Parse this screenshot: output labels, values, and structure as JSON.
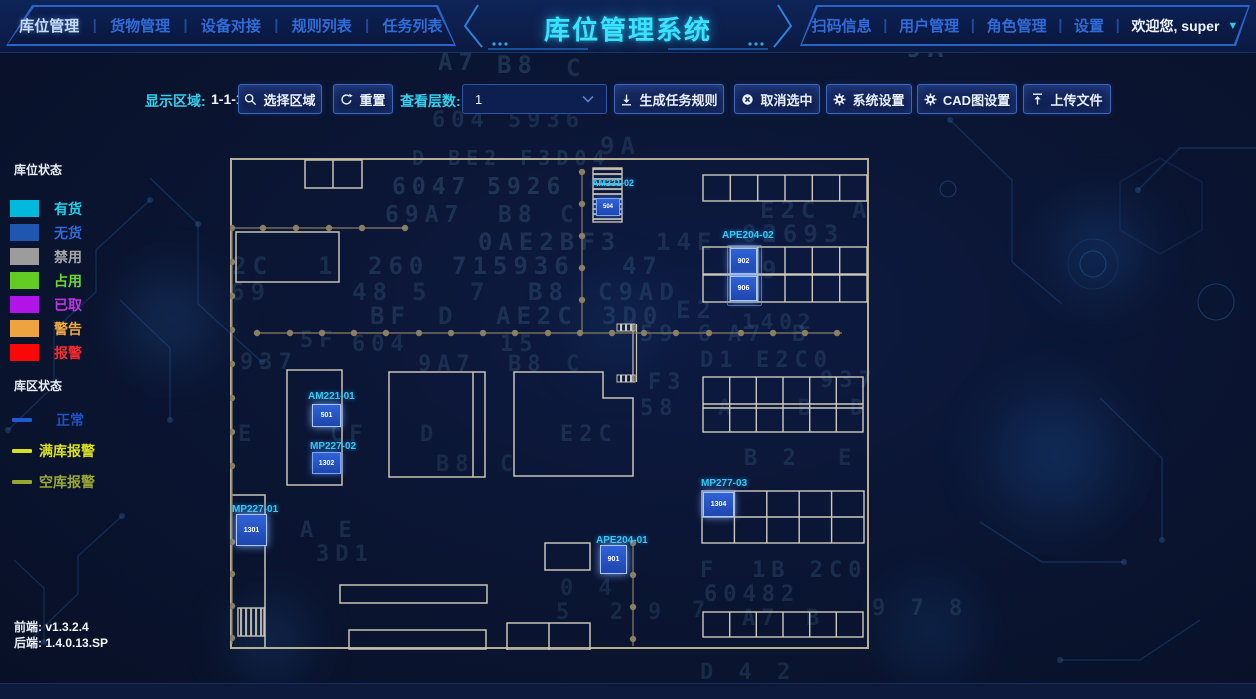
{
  "header": {
    "nav_left": [
      {
        "label": "库位管理"
      },
      {
        "label": "货物管理"
      },
      {
        "label": "设备对接"
      },
      {
        "label": "规则列表"
      },
      {
        "label": "任务列表"
      }
    ],
    "title": "库位管理系统",
    "nav_right": [
      {
        "label": "扫码信息"
      },
      {
        "label": "用户管理"
      },
      {
        "label": "角色管理"
      },
      {
        "label": "设置"
      }
    ],
    "welcome": "欢迎您, super"
  },
  "toolbar": {
    "display_area_label": "显示区域:",
    "display_area_value": "1-1-1",
    "select_area": "选择区域",
    "reset": "重置",
    "layer_label": "查看层数:",
    "layer_value": "1",
    "generate_rules": "生成任务规则",
    "cancel_selected": "取消选中",
    "system_settings": "系统设置",
    "cad_settings": "CAD图设置",
    "upload_file": "上传文件"
  },
  "legend": {
    "slot_status_title": "库位状态",
    "slot_statuses": [
      {
        "label": "有货",
        "color": "#00b9dc",
        "text_color": "#19d3f0"
      },
      {
        "label": "无货",
        "color": "#1f56b0",
        "text_color": "#2e6ad8"
      },
      {
        "label": "禁用",
        "color": "#9c9c9c",
        "text_color": "#a8a8a8"
      },
      {
        "label": "占用",
        "color": "#62cc25",
        "text_color": "#6ed832"
      },
      {
        "label": "已取",
        "color": "#b014e6",
        "text_color": "#c233ee"
      },
      {
        "label": "警告",
        "color": "#eda33f",
        "text_color": "#f2a93e"
      },
      {
        "label": "报警",
        "color": "#fb0707",
        "text_color": "#ff2a2a"
      }
    ],
    "zone_status_title": "库区状态",
    "zone_statuses": [
      {
        "label": "正常",
        "color": "#1f5ad4",
        "text_color": "#1d52c8"
      },
      {
        "label": "满库报警",
        "color": "#d8df21",
        "text_color": "#dce11f"
      },
      {
        "label": "空库报警",
        "color": "#99a62e",
        "text_color": "#9aa635"
      }
    ]
  },
  "versions": {
    "frontend_label": "前端:",
    "frontend_value": "v1.3.2.4",
    "backend_label": "后端:",
    "backend_value": "1.4.0.13.SP"
  },
  "map": {
    "units": {
      "am221_02": {
        "id": "AM221-02",
        "cell": "504"
      },
      "ape204_02": {
        "id": "APE204-02",
        "cell_top": "902",
        "cell_bottom": "906"
      },
      "am221_01": {
        "id": "AM221-01",
        "cell": "501"
      },
      "mp227_02": {
        "id": "MP227-02",
        "cell": "1302"
      },
      "mp227_01": {
        "id": "MP227-01",
        "cell": "1301"
      },
      "ape204_01": {
        "id": "APE204-01",
        "cell": "901"
      },
      "mp277_03": {
        "id": "MP277-03",
        "cell": "1304"
      }
    }
  },
  "background_chars": [
    {
      "t": "6132C04",
      "x": 168,
      "y": 30,
      "s": 17,
      "o": 0.1
    },
    {
      "t": "15F3604",
      "x": 330,
      "y": 32,
      "s": 17,
      "o": 0.12
    },
    {
      "t": "CF",
      "x": 492,
      "y": 14,
      "s": 15,
      "o": 0.16
    },
    {
      "t": "5F 60",
      "x": 468,
      "y": 34,
      "s": 15,
      "o": 0.13
    },
    {
      "t": "A7",
      "x": 438,
      "y": 48,
      "s": 24,
      "o": 0.16
    },
    {
      "t": "B8",
      "x": 497,
      "y": 51,
      "s": 24,
      "o": 0.16
    },
    {
      "t": "C",
      "x": 566,
      "y": 54,
      "s": 24,
      "o": 0.14
    },
    {
      "t": "9A",
      "x": 906,
      "y": 34,
      "s": 26,
      "o": 0.2
    },
    {
      "t": "E",
      "x": 486,
      "y": 86,
      "s": 22,
      "o": 0.14
    },
    {
      "t": "C0",
      "x": 536,
      "y": 86,
      "s": 22,
      "o": 0.14
    },
    {
      "t": "E2C04",
      "x": 806,
      "y": 86,
      "s": 22,
      "o": 0.11
    },
    {
      "t": "604",
      "x": 432,
      "y": 108,
      "s": 22,
      "o": 0.13
    },
    {
      "t": "5936",
      "x": 508,
      "y": 108,
      "s": 22,
      "o": 0.12
    },
    {
      "t": "9A",
      "x": 600,
      "y": 132,
      "s": 24,
      "o": 0.13
    },
    {
      "t": "D  BE2  F3D04",
      "x": 412,
      "y": 146,
      "s": 20,
      "o": 0.14
    },
    {
      "t": "6047",
      "x": 392,
      "y": 174,
      "s": 23,
      "o": 0.16
    },
    {
      "t": "5926",
      "x": 487,
      "y": 174,
      "s": 23,
      "o": 0.16
    },
    {
      "t": "69A7",
      "x": 385,
      "y": 202,
      "s": 23,
      "o": 0.15
    },
    {
      "t": "B8",
      "x": 498,
      "y": 202,
      "s": 23,
      "o": 0.14
    },
    {
      "t": "C",
      "x": 560,
      "y": 202,
      "s": 23,
      "o": 0.12
    },
    {
      "t": "E2C",
      "x": 760,
      "y": 196,
      "s": 24,
      "o": 0.13
    },
    {
      "t": "A",
      "x": 852,
      "y": 196,
      "s": 24,
      "o": 0.12
    },
    {
      "t": "0AE2BF3",
      "x": 478,
      "y": 228,
      "s": 24,
      "o": 0.15
    },
    {
      "t": "14E",
      "x": 656,
      "y": 228,
      "s": 24,
      "o": 0.12
    },
    {
      "t": "82693",
      "x": 742,
      "y": 220,
      "s": 24,
      "o": 0.12
    },
    {
      "t": "2C",
      "x": 232,
      "y": 252,
      "s": 24,
      "o": 0.13
    },
    {
      "t": "1",
      "x": 318,
      "y": 252,
      "s": 24,
      "o": 0.13
    },
    {
      "t": "260",
      "x": 368,
      "y": 252,
      "s": 24,
      "o": 0.14
    },
    {
      "t": "715936",
      "x": 452,
      "y": 252,
      "s": 24,
      "o": 0.15
    },
    {
      "t": "47",
      "x": 622,
      "y": 252,
      "s": 24,
      "o": 0.13
    },
    {
      "t": "9",
      "x": 762,
      "y": 256,
      "s": 24,
      "o": 0.12
    },
    {
      "t": "69",
      "x": 230,
      "y": 278,
      "s": 24,
      "o": 0.12
    },
    {
      "t": "48",
      "x": 352,
      "y": 278,
      "s": 24,
      "o": 0.13
    },
    {
      "t": "5",
      "x": 412,
      "y": 278,
      "s": 24,
      "o": 0.12
    },
    {
      "t": "7",
      "x": 470,
      "y": 278,
      "s": 24,
      "o": 0.12
    },
    {
      "t": "B8",
      "x": 528,
      "y": 278,
      "s": 24,
      "o": 0.14
    },
    {
      "t": "C9AD",
      "x": 598,
      "y": 278,
      "s": 24,
      "o": 0.12
    },
    {
      "t": "BF",
      "x": 370,
      "y": 302,
      "s": 24,
      "o": 0.14
    },
    {
      "t": "D",
      "x": 438,
      "y": 302,
      "s": 24,
      "o": 0.12
    },
    {
      "t": "AE2C",
      "x": 496,
      "y": 302,
      "s": 24,
      "o": 0.14
    },
    {
      "t": "3D0",
      "x": 602,
      "y": 302,
      "s": 24,
      "o": 0.12
    },
    {
      "t": "E2",
      "x": 676,
      "y": 296,
      "s": 24,
      "o": 0.12
    },
    {
      "t": "1402",
      "x": 742,
      "y": 310,
      "s": 21,
      "o": 0.12
    },
    {
      "t": "5F",
      "x": 300,
      "y": 328,
      "s": 22,
      "o": 0.13
    },
    {
      "t": "604",
      "x": 352,
      "y": 332,
      "s": 22,
      "o": 0.12
    },
    {
      "t": "15",
      "x": 500,
      "y": 332,
      "s": 22,
      "o": 0.13
    },
    {
      "t": "59  6",
      "x": 640,
      "y": 322,
      "s": 22,
      "o": 0.12
    },
    {
      "t": "A7",
      "x": 728,
      "y": 322,
      "s": 22,
      "o": 0.12
    },
    {
      "t": "B",
      "x": 792,
      "y": 322,
      "s": 22,
      "o": 0.12
    },
    {
      "t": "937",
      "x": 240,
      "y": 350,
      "s": 22,
      "o": 0.13
    },
    {
      "t": "9A7",
      "x": 418,
      "y": 352,
      "s": 22,
      "o": 0.13
    },
    {
      "t": "B8",
      "x": 508,
      "y": 352,
      "s": 22,
      "o": 0.13
    },
    {
      "t": "C",
      "x": 566,
      "y": 352,
      "s": 22,
      "o": 0.11
    },
    {
      "t": "D1",
      "x": 700,
      "y": 348,
      "s": 22,
      "o": 0.12
    },
    {
      "t": "E2C0",
      "x": 756,
      "y": 348,
      "s": 22,
      "o": 0.12
    },
    {
      "t": "F3",
      "x": 648,
      "y": 370,
      "s": 22,
      "o": 0.12
    },
    {
      "t": "937",
      "x": 820,
      "y": 368,
      "s": 22,
      "o": 0.12
    },
    {
      "t": "58",
      "x": 640,
      "y": 396,
      "s": 22,
      "o": 0.12
    },
    {
      "t": "A",
      "x": 718,
      "y": 396,
      "s": 22,
      "o": 0.11
    },
    {
      "t": "B",
      "x": 798,
      "y": 396,
      "s": 22,
      "o": 0.11
    },
    {
      "t": "D",
      "x": 850,
      "y": 396,
      "s": 22,
      "o": 0.11
    },
    {
      "t": "E",
      "x": 238,
      "y": 422,
      "s": 22,
      "o": 0.12
    },
    {
      "t": "CF",
      "x": 330,
      "y": 422,
      "s": 22,
      "o": 0.12
    },
    {
      "t": "D",
      "x": 420,
      "y": 422,
      "s": 22,
      "o": 0.11
    },
    {
      "t": "E2C",
      "x": 560,
      "y": 422,
      "s": 22,
      "o": 0.12
    },
    {
      "t": "B8",
      "x": 436,
      "y": 452,
      "s": 22,
      "o": 0.11
    },
    {
      "t": "C",
      "x": 500,
      "y": 452,
      "s": 22,
      "o": 0.11
    },
    {
      "t": "B 2",
      "x": 744,
      "y": 446,
      "s": 22,
      "o": 0.12
    },
    {
      "t": "E",
      "x": 838,
      "y": 446,
      "s": 22,
      "o": 0.11
    },
    {
      "t": "A E",
      "x": 300,
      "y": 518,
      "s": 22,
      "o": 0.13
    },
    {
      "t": "3D1",
      "x": 316,
      "y": 542,
      "s": 22,
      "o": 0.12
    },
    {
      "t": "0 4",
      "x": 560,
      "y": 576,
      "s": 22,
      "o": 0.11
    },
    {
      "t": "F",
      "x": 700,
      "y": 558,
      "s": 22,
      "o": 0.12
    },
    {
      "t": "1B 2C0",
      "x": 752,
      "y": 558,
      "s": 22,
      "o": 0.13
    },
    {
      "t": "60482",
      "x": 704,
      "y": 582,
      "s": 22,
      "o": 0.13
    },
    {
      "t": "5",
      "x": 556,
      "y": 600,
      "s": 22,
      "o": 0.11
    },
    {
      "t": "2",
      "x": 610,
      "y": 600,
      "s": 22,
      "o": 0.11
    },
    {
      "t": "9",
      "x": 648,
      "y": 600,
      "s": 22,
      "o": 0.11
    },
    {
      "t": "7",
      "x": 692,
      "y": 598,
      "s": 22,
      "o": 0.11
    },
    {
      "t": "A7",
      "x": 742,
      "y": 606,
      "s": 22,
      "o": 0.12
    },
    {
      "t": "B",
      "x": 806,
      "y": 606,
      "s": 22,
      "o": 0.11
    },
    {
      "t": "9 7 8",
      "x": 872,
      "y": 596,
      "s": 22,
      "o": 0.12
    },
    {
      "t": "D 4 2",
      "x": 700,
      "y": 660,
      "s": 22,
      "o": 0.12
    }
  ]
}
